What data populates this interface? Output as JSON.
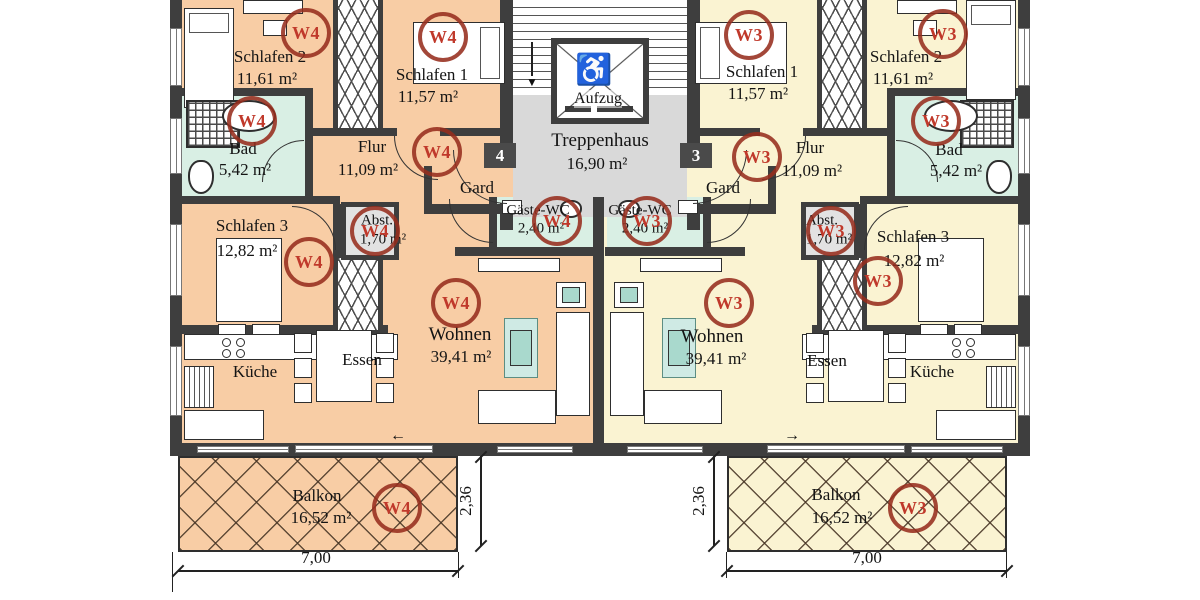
{
  "floorplan": {
    "units": {
      "w4": {
        "id": "W4",
        "badge": "4",
        "rooms": {
          "schlafen1": {
            "name": "Schlafen 1",
            "area": "11,57 m²"
          },
          "schlafen2": {
            "name": "Schlafen 2",
            "area": "11,61 m²"
          },
          "schlafen3": {
            "name": "Schlafen 3",
            "area": "12,82 m²"
          },
          "bad": {
            "name": "Bad",
            "area": "5,42 m²"
          },
          "flur": {
            "name": "Flur",
            "area": "11,09 m²"
          },
          "abstellraum": {
            "name": "Abst.",
            "area": "1,70 m²"
          },
          "garderobe": {
            "name": "Gard"
          },
          "gaeste_wc": {
            "name": "Gäste-WC",
            "area": "2,40 m²"
          },
          "wohnen": {
            "name": "Wohnen",
            "area": "39,41 m²"
          },
          "essen": {
            "name": "Essen"
          },
          "kueche": {
            "name": "Küche"
          },
          "balkon": {
            "name": "Balkon",
            "area": "16,52 m²"
          }
        }
      },
      "w3": {
        "id": "W3",
        "badge": "3",
        "rooms": {
          "schlafen1": {
            "name": "Schlafen 1",
            "area": "11,57 m²"
          },
          "schlafen2": {
            "name": "Schlafen 2",
            "area": "11,61 m²"
          },
          "schlafen3": {
            "name": "Schlafen 3",
            "area": "12,82 m²"
          },
          "bad": {
            "name": "Bad",
            "area": "5,42 m²"
          },
          "flur": {
            "name": "Flur",
            "area": "11,09 m²"
          },
          "abstellraum": {
            "name": "Abst.",
            "area": "1,70 m²"
          },
          "garderobe": {
            "name": "Gard"
          },
          "gaeste_wc": {
            "name": "Gäste-WC",
            "area": "2,40 m²"
          },
          "wohnen": {
            "name": "Wohnen",
            "area": "39,41 m²"
          },
          "essen": {
            "name": "Essen"
          },
          "kueche": {
            "name": "Küche"
          },
          "balkon": {
            "name": "Balkon",
            "area": "16,52 m²"
          }
        }
      }
    },
    "shared": {
      "treppenhaus": {
        "name": "Treppenhaus",
        "area": "16,90 m²"
      },
      "aufzug": {
        "name": "Aufzug",
        "symbol": "♿"
      }
    },
    "dimensions": {
      "balkon_breite": "7,00",
      "balkon_tiefe": "2,36"
    },
    "symbols": {
      "arrow_left": "←",
      "arrow_right": "→",
      "stair_arrow": "▼"
    },
    "colors": {
      "w4_fill": "#f8cda5",
      "w3_fill": "#faf3d2",
      "wet_fill": "#d9efe4",
      "stair_fill": "#d9d9d9",
      "wall": "#3e3e3e",
      "marker": "#a93b2b"
    }
  }
}
